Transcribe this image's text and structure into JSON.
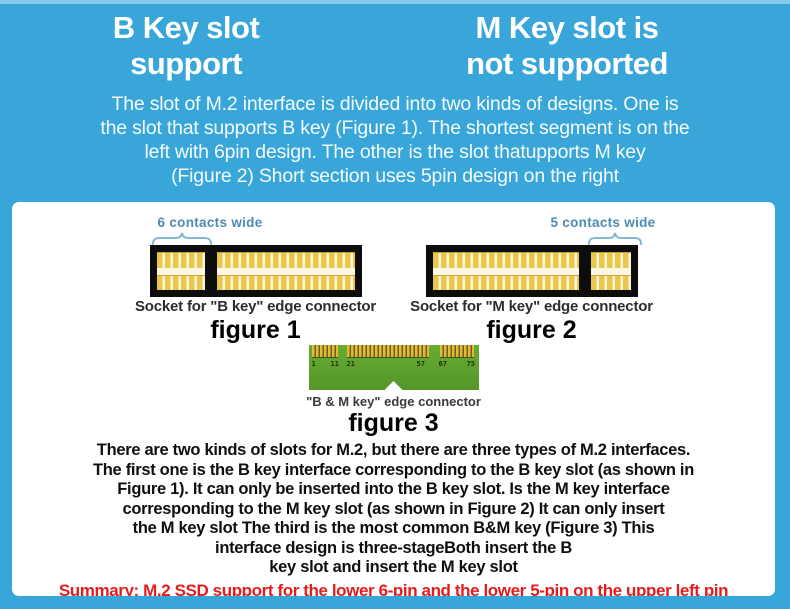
{
  "colors": {
    "background": "#39a6da",
    "top_edge_highlight": "#85c9e9",
    "panel": "#ffffff",
    "heading_text": "#ffffff",
    "annotation_blue": "#4e8bb4",
    "socket_black": "#0d0d0d",
    "pin_gold": "#e9c74b",
    "pcb_green": "#5da32c",
    "body_text": "#0f0f0f",
    "summary_red": "#e31c1c"
  },
  "headings": {
    "left_line1": "B Key slot",
    "left_line2": "support",
    "right_line1": "M Key slot is",
    "right_line2": "not supported"
  },
  "intro": {
    "lines": [
      "The slot of M.2 interface is divided into two kinds of designs. One is",
      "the slot that supports B key (Figure 1). The shortest segment is on the",
      "left with 6pin design. The other is the slot thatupports M key",
      "(Figure 2) Short section uses 5pin design on the right"
    ]
  },
  "figures": {
    "fig1": {
      "annotation": "6 contacts wide",
      "caption": "Socket for \"B key\" edge connector",
      "label": "figure 1"
    },
    "fig2": {
      "annotation": "5 contacts wide",
      "caption": "Socket for \"M key\" edge connector",
      "label": "figure 2"
    },
    "fig3": {
      "caption": "\"B & M key\" edge connector",
      "label": "figure 3",
      "pin_numbers": [
        "1",
        "11",
        "21",
        "57",
        "67",
        "75"
      ]
    }
  },
  "body": {
    "lines": [
      "There are two kinds of slots for M.2, but there are three types of M.2 interfaces.",
      "The first one is the B key interface corresponding to the B key slot (as shown in",
      "Figure 1). It can only be inserted into the B key slot. Is the M key interface",
      "corresponding to the M key slot (as shown in Figure 2) It can only insert",
      "the M key slot The third is the most common B&M key (Figure 3) This",
      "interface design is three-stageBoth insert the B",
      "key slot and insert the M key slot"
    ]
  },
  "summary": "Summary: M.2 SSD support for the lower 6-pin and the lower 5-pin on the upper left pin"
}
